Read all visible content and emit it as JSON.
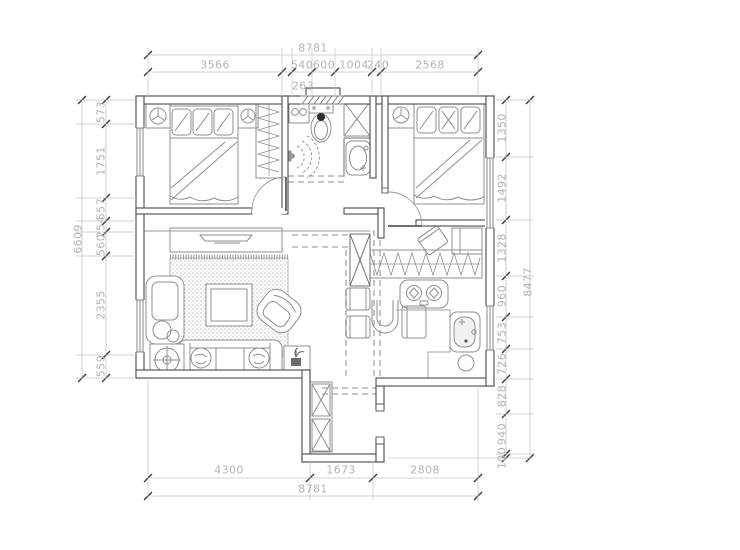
{
  "drawing": {
    "type": "architectural floor plan",
    "units": "mm",
    "colors": {
      "wall_line": "#4a4a4a",
      "furniture_line": "#8f8f8f",
      "dimension_line": "#c4c4c4",
      "dimension_text": "#b4b4b4",
      "tick_mark": "#3c3c3c",
      "dark_fill": "#2d2d2d"
    }
  },
  "dimensions": {
    "top": {
      "total": "8781",
      "segments": [
        "3566",
        "540",
        "600",
        "1004",
        "240",
        "2568"
      ],
      "inset_segment": "263"
    },
    "bottom": {
      "total": "8781",
      "segments": [
        "4300",
        "1673",
        "2808"
      ]
    },
    "left": {
      "total": "6609",
      "segments_top_to_bottom": [
        "573",
        "1751",
        "557",
        "254",
        "560",
        "2355",
        "559"
      ]
    },
    "right": {
      "total": "8477",
      "segments_top_to_bottom": [
        "1350",
        "1492",
        "1328",
        "960",
        "753",
        "726",
        "828",
        "940",
        "100"
      ]
    }
  }
}
